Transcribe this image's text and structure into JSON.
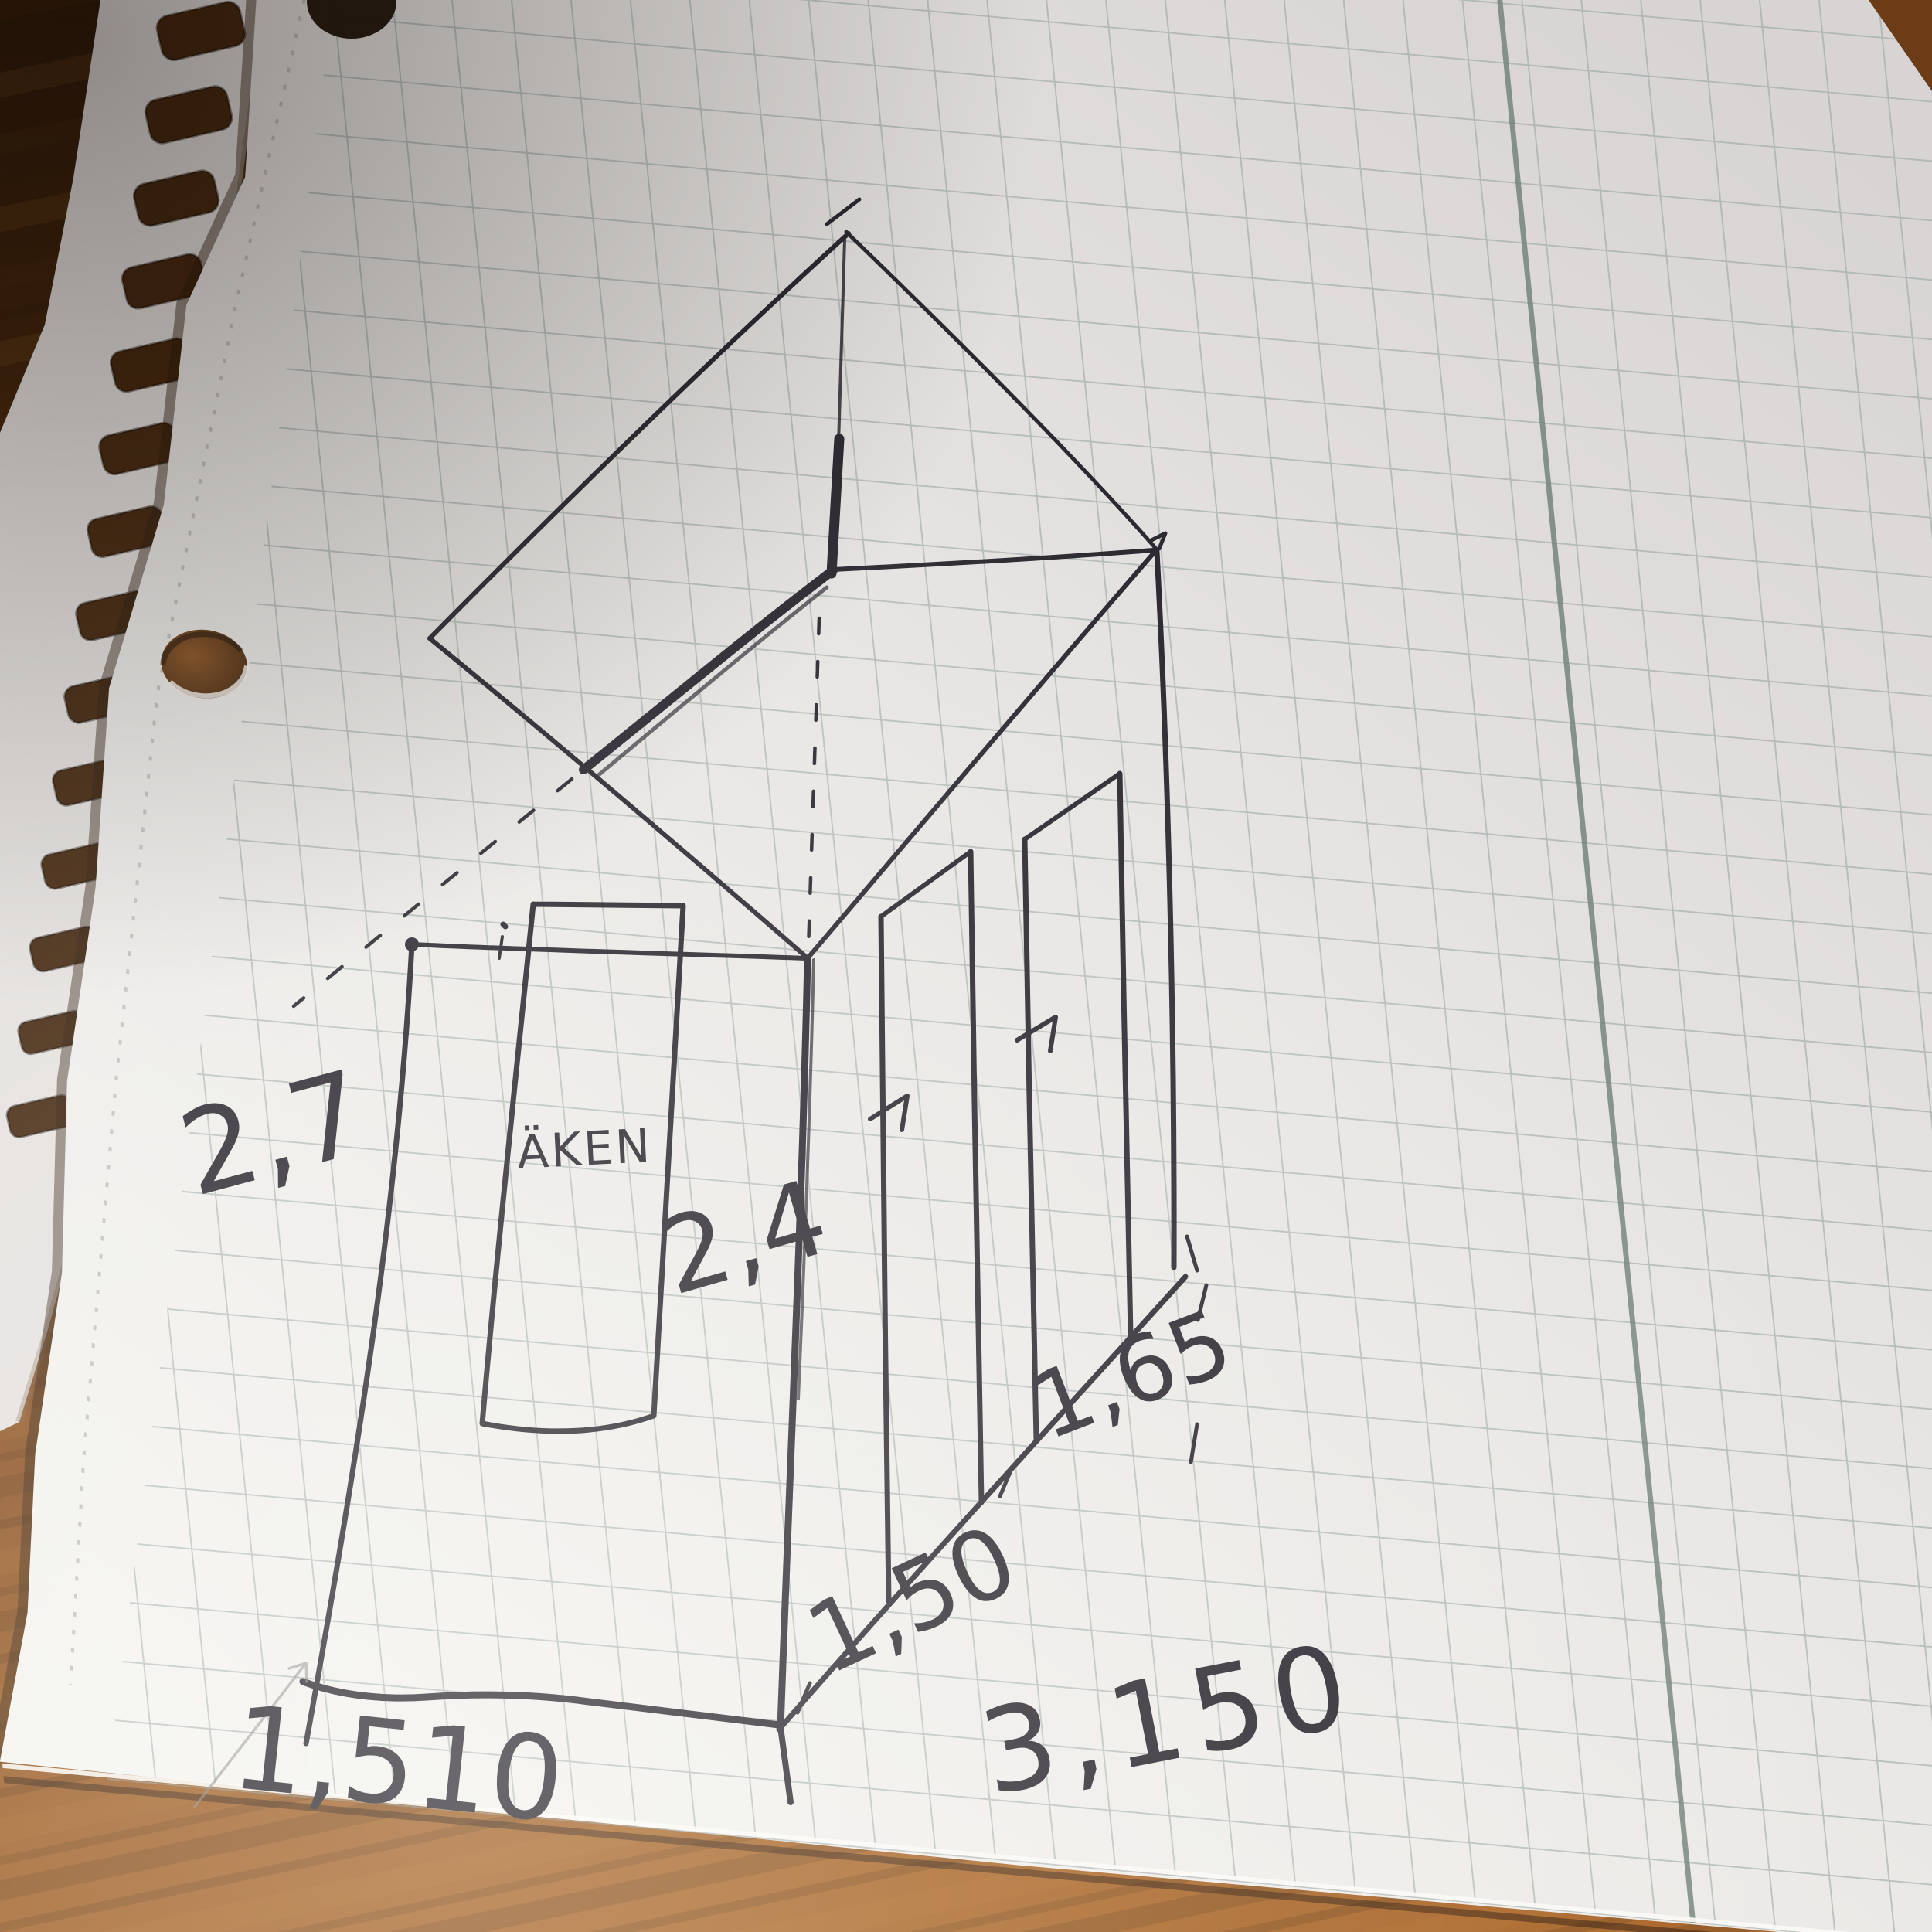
{
  "sketch": {
    "window_label": "ÄKEN",
    "dimensions": {
      "height_left": "2,7",
      "height_middle": "2,4",
      "width_bottom_left": "1,510",
      "width_diagonal_near": "1,50",
      "width_diagonal_far": "1,65",
      "width_bottom_right": "3,150"
    }
  },
  "colors": {
    "ink": "#2b2830",
    "pencil": "#8a8786",
    "paper": "#e9e6e4",
    "grid_line": "#93a09e",
    "margin_line": "#75857c",
    "wood_dark": "#2c1808",
    "wood_mid": "#6b3c16",
    "wood_light": "#a86426"
  }
}
